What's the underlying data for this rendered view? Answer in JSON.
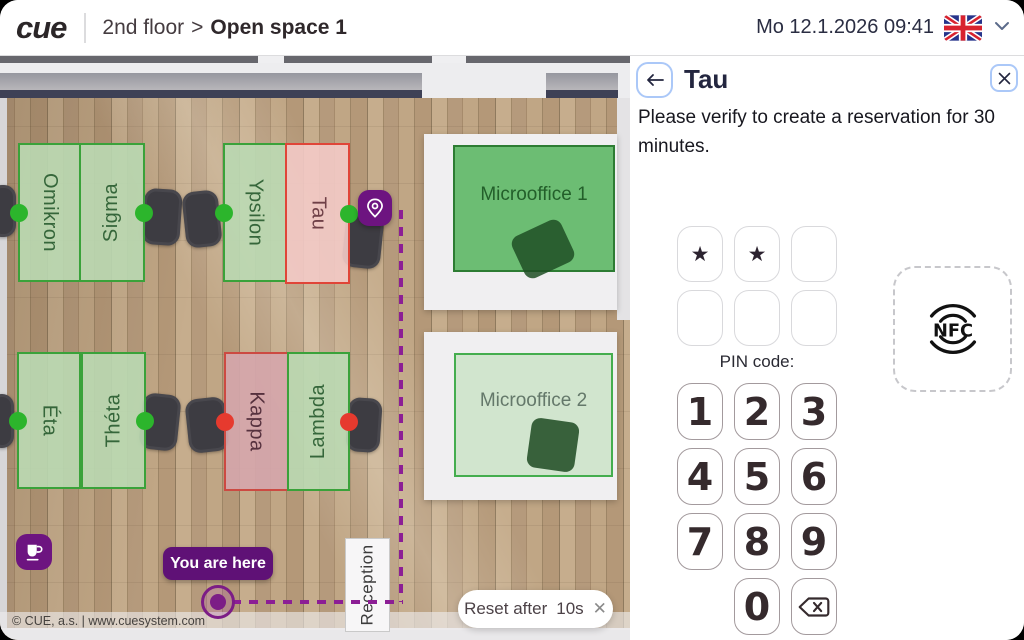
{
  "header": {
    "logo": "cue",
    "breadcrumb": {
      "floor": "2nd floor",
      "separator": ">",
      "room": "Open space 1"
    },
    "datetime": "Mo 12.1.2026 09:41",
    "language_flag": "united-kingdom"
  },
  "map": {
    "desks": [
      {
        "name": "Omikron",
        "state": "free",
        "dot": "green"
      },
      {
        "name": "Sigma",
        "state": "free",
        "dot": "green"
      },
      {
        "name": "Ypsilon",
        "state": "free",
        "dot": "green"
      },
      {
        "name": "Tau",
        "state": "selected",
        "dot": "green"
      },
      {
        "name": "Éta",
        "state": "free",
        "dot": "green"
      },
      {
        "name": "Théta",
        "state": "free",
        "dot": "green"
      },
      {
        "name": "Kappa",
        "state": "occupied",
        "dot": "red"
      },
      {
        "name": "Lambda",
        "state": "free",
        "dot": "red"
      }
    ],
    "rooms": [
      {
        "name": "Microoffice 1",
        "state": "highlighted-green"
      },
      {
        "name": "Microoffice 2",
        "state": "pale-green"
      }
    ],
    "reception": "Reception",
    "you_are_here": "You are here",
    "reset": {
      "label": "Reset after",
      "countdown": "10s",
      "close_icon": "✕"
    },
    "copyright": "© CUE, a.s. | www.cuesystem.com"
  },
  "panel": {
    "title": "Tau",
    "message": "Please verify to create a reservation for 30 minutes.",
    "pin": {
      "label": "PIN code:",
      "mask": "★",
      "entered": 2,
      "boxes": 6
    },
    "keypad": [
      "1",
      "2",
      "3",
      "4",
      "5",
      "6",
      "7",
      "8",
      "9",
      "0"
    ],
    "nfc": "NFC"
  },
  "colors": {
    "accent_purple": "#6d1480",
    "path_purple": "#8c1e95",
    "free_green": "#2cb52c",
    "busy_red": "#e63a2e",
    "selected_border_red": "#e04538",
    "desk_border_green": "#3aa23a",
    "focus_border_blue": "#abc8f8"
  }
}
